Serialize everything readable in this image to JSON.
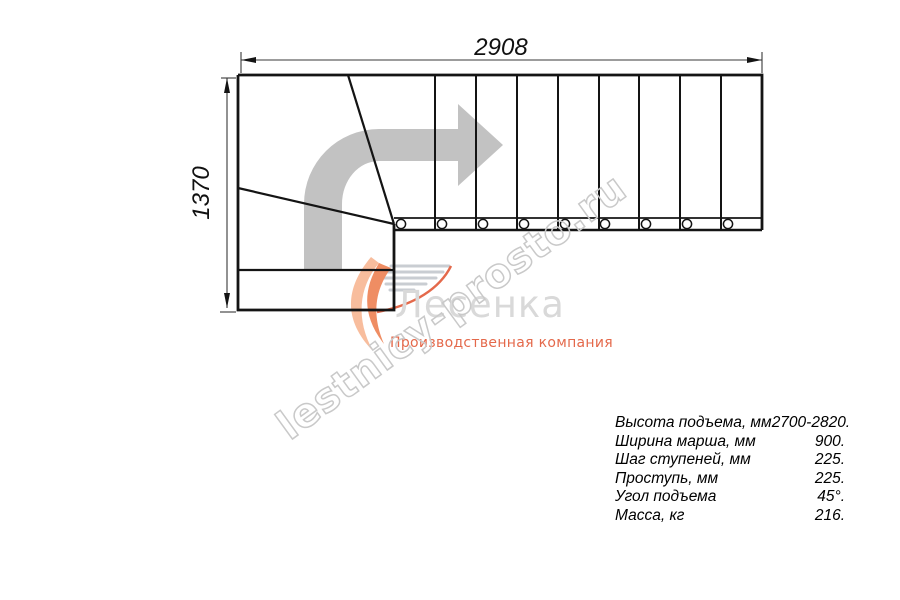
{
  "drawing": {
    "dim_width_label": "2908",
    "dim_height_label": "1370"
  },
  "watermark": {
    "text": "lestnicy-prosto.ru"
  },
  "logo": {
    "name": "Лесенка",
    "tagline": "Производственная компания"
  },
  "specs": {
    "rows": [
      {
        "label": "Высота подъема, мм",
        "value": "2700-2820."
      },
      {
        "label": "Ширина марша, мм",
        "value": "900."
      },
      {
        "label": "Шаг ступеней, мм",
        "value": "225."
      },
      {
        "label": "Проступь, мм",
        "value": "225."
      },
      {
        "label": "Угол подъема",
        "value": "45°."
      },
      {
        "label": "Масса, кг",
        "value": "216."
      }
    ]
  },
  "colors": {
    "line": "#141414",
    "dim_line": "#3a3a3a",
    "direction_arrow": "#c2c2c2",
    "watermark_gray": "#c9c9c9",
    "logo_gray": "#d9d9d9",
    "logo_orange": "#ef8d63",
    "logo_orange_light": "#f8bd9d",
    "tagline_orange": "#e4694b",
    "speed_line_gray": "#c9cdd2"
  }
}
